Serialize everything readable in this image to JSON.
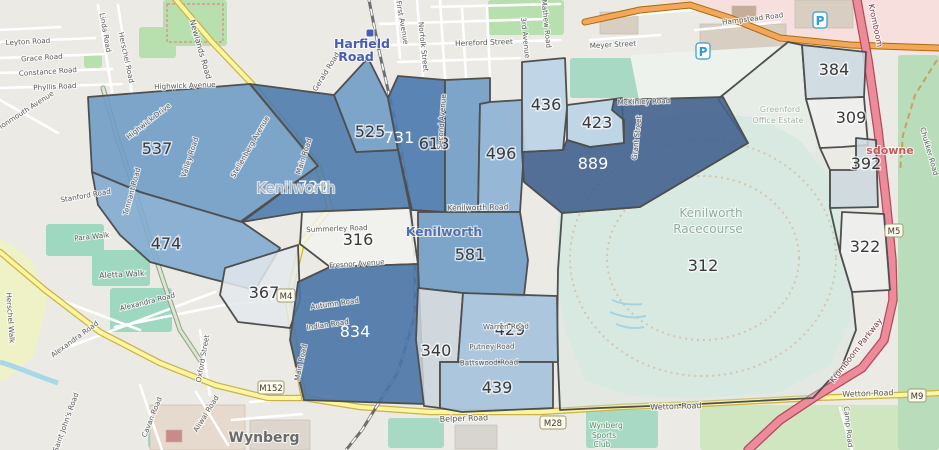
{
  "map": {
    "colors": {
      "region_border": "#4f4f4f",
      "road_yellow": "#fdf6a0",
      "road_orange": "#f2a75c",
      "road_trunk_pink": "#ec8b99",
      "racecourse_green": "#d9ece3",
      "park_green": "#b7e0ae",
      "pitch_teal": "#a8d9c4",
      "railway_gray": "#6e6e6e",
      "station_blue": "#4a5db5"
    },
    "regions": [
      {
        "value": "312",
        "fill": "#d5e6de",
        "text": "#3a3a3a",
        "lx": 703,
        "ly": 265,
        "opacity": 0.35,
        "points": "718,99 788,42 802,45 806,99 812,120 820,148 830,170 830,208 840,252 852,292 856,330 842,366 813,398 700,404 600,408 560,410 557,340 558,270 562,213 640,207 748,143"
      },
      {
        "value": "537",
        "fill": "#6d9bc6",
        "text": "#3a3a3a",
        "lx": 157,
        "ly": 148,
        "opacity": 0.88,
        "points": "88,97 250,84 318,166 240,222 140,192 92,172"
      },
      {
        "value": "720",
        "fill": "#4a79ad",
        "text": "#ffffff",
        "lx": 313,
        "ly": 186,
        "opacity": 0.88,
        "points": "250,84 334,95 356,152 398,150 410,208 302,212 242,222 318,166"
      },
      {
        "value": "525",
        "fill": "#6d9bc6",
        "text": "#3a3a3a",
        "lx": 370,
        "ly": 131,
        "opacity": 0.88,
        "points": "334,95 368,58 388,98 398,150 356,152"
      },
      {
        "value": "731",
        "fill": "#4a79ad",
        "text": "#ffffff",
        "lx": 399,
        "ly": 137,
        "opacity": 0.9,
        "points": "388,98 398,76 445,80 445,212 412,210 398,150"
      },
      {
        "value": "618",
        "fill": "#6d9bc6",
        "text": "#3a3a3a",
        "lx": 434,
        "ly": 143,
        "opacity": 0.88,
        "points": "445,80 490,78 490,102 480,104 478,212 445,212"
      },
      {
        "value": "496",
        "fill": "#8ab1d4",
        "text": "#3a3a3a",
        "lx": 501,
        "ly": 153,
        "opacity": 0.88,
        "points": "490,102 522,100 524,150 520,212 478,212 480,104"
      },
      {
        "value": "436",
        "fill": "#b9d2e6",
        "text": "#3a3a3a",
        "lx": 546,
        "ly": 104,
        "opacity": 0.88,
        "points": "522,62 565,58 567,108 563,150 522,152"
      },
      {
        "value": "423",
        "fill": "#b9d2e6",
        "text": "#3a3a3a",
        "lx": 597,
        "ly": 122,
        "opacity": 0.88,
        "points": "567,105 622,98 624,143 590,147 567,140"
      },
      {
        "value": "889",
        "fill": "#42628e",
        "text": "#ffffff",
        "lx": 593,
        "ly": 163,
        "opacity": 0.9,
        "points": "522,152 563,150 567,140 590,147 624,143 624,120 612,110 614,100 723,97 748,143 640,207 562,213 524,182"
      },
      {
        "value": "384",
        "fill": "#ccd9e2",
        "text": "#3a3a3a",
        "lx": 834,
        "ly": 69,
        "opacity": 0.85,
        "points": "802,45 866,52 864,97 806,99"
      },
      {
        "value": "309",
        "fill": "#eef0ef",
        "text": "#3a3a3a",
        "lx": 851,
        "ly": 117,
        "opacity": 0.85,
        "points": "806,99 864,97 868,145 842,147 820,148 812,120"
      },
      {
        "value": "392",
        "fill": "#cdd8de",
        "text": "#3a3a3a",
        "lx": 866,
        "ly": 163,
        "opacity": 0.85,
        "points": "856,138 876,140 878,207 830,208 830,170 856,170"
      },
      {
        "value": "322",
        "fill": "#eef0ef",
        "text": "#3a3a3a",
        "lx": 865,
        "ly": 246,
        "opacity": 0.85,
        "points": "842,212 884,214 890,290 852,292 840,252"
      },
      {
        "value": "474",
        "fill": "#7fa8cf",
        "text": "#3a3a3a",
        "lx": 166,
        "ly": 243,
        "opacity": 0.88,
        "points": "92,172 140,192 242,222 280,248 255,290 208,278 150,262 120,235 98,205"
      },
      {
        "value": "367",
        "fill": "#e4e9ec",
        "text": "#3a3a3a",
        "lx": 264,
        "ly": 292,
        "opacity": 0.85,
        "points": "225,268 298,245 300,300 290,328 238,322 220,295"
      },
      {
        "value": "316",
        "fill": "#f2f2f0",
        "text": "#3a3a3a",
        "lx": 358,
        "ly": 239,
        "opacity": 0.85,
        "points": "302,212 410,208 418,264 330,267 300,244"
      },
      {
        "value": "581",
        "fill": "#6d9bc6",
        "text": "#3a3a3a",
        "lx": 470,
        "ly": 254,
        "opacity": 0.88,
        "points": "418,212 520,212 528,260 524,296 463,293 418,288"
      },
      {
        "value": "834",
        "fill": "#4a74a6",
        "text": "#ffffff",
        "lx": 355,
        "ly": 331,
        "opacity": 0.9,
        "points": "330,267 418,264 424,404 304,400 290,340 298,282"
      },
      {
        "value": "340",
        "fill": "#ccd5dc",
        "text": "#3a3a3a",
        "lx": 436,
        "ly": 350,
        "opacity": 0.85,
        "points": "418,288 463,293 458,362 440,362 440,408 424,406 416,340"
      },
      {
        "value": "429",
        "fill": "#a3c2dc",
        "text": "#3a3a3a",
        "lx": 510,
        "ly": 329,
        "opacity": 0.88,
        "points": "463,293 557,296 558,362 458,362"
      },
      {
        "value": "439",
        "fill": "#a3c2dc",
        "text": "#3a3a3a",
        "lx": 497,
        "ly": 387,
        "opacity": 0.88,
        "points": "440,362 553,362 553,408 462,412 440,408"
      }
    ],
    "place_labels": [
      {
        "t": "Harfield",
        "x": 362,
        "y": 48,
        "s": 12.5,
        "c": "#4a5db5",
        "b": true
      },
      {
        "t": "Road",
        "x": 356,
        "y": 61,
        "s": 12.5,
        "c": "#4a5db5",
        "b": true
      },
      {
        "t": "Kenilworth",
        "x": 296,
        "y": 193,
        "s": 15,
        "c": "#a8b0b8",
        "b": false
      },
      {
        "t": "Kenilworth",
        "x": 444,
        "y": 236,
        "s": 12.5,
        "c": "#5570ae",
        "b": true
      },
      {
        "t": "Kenilworth",
        "x": 711,
        "y": 217,
        "s": 12,
        "c": "#93ac9e",
        "b": false
      },
      {
        "t": "Racecourse",
        "x": 708,
        "y": 233,
        "s": 12,
        "c": "#93ac9e",
        "b": false
      },
      {
        "t": "Greenford",
        "x": 780,
        "y": 112,
        "s": 8,
        "c": "#a3b2a3",
        "b": false
      },
      {
        "t": "Office Estate",
        "x": 778,
        "y": 123,
        "s": 8,
        "c": "#a3b2a3",
        "b": false
      },
      {
        "t": "Wynberg",
        "x": 264,
        "y": 442,
        "s": 14,
        "c": "#6b6b6b",
        "b": true
      },
      {
        "t": "Wynberg",
        "x": 606,
        "y": 428,
        "s": 7.5,
        "c": "#4f8f63",
        "b": false
      },
      {
        "t": "Sports",
        "x": 604,
        "y": 438,
        "s": 7.5,
        "c": "#4f8f63",
        "b": false
      },
      {
        "t": "Club",
        "x": 602,
        "y": 447,
        "s": 7.5,
        "c": "#4f8f63",
        "b": false
      },
      {
        "t": "sdowne",
        "x": 890,
        "y": 154,
        "s": 11,
        "c": "#cc5555",
        "b": true
      }
    ],
    "street_labels": [
      {
        "t": "Leyton Road",
        "x": 28,
        "y": 44,
        "r": -3
      },
      {
        "t": "Grace Road",
        "x": 42,
        "y": 60,
        "r": -4
      },
      {
        "t": "Constance Road",
        "x": 48,
        "y": 74,
        "r": -4
      },
      {
        "t": "Phyllis Road",
        "x": 55,
        "y": 89,
        "r": -3
      },
      {
        "t": "Monmouth Avenue",
        "x": 26,
        "y": 113,
        "r": -33
      },
      {
        "t": "Newlands Road",
        "x": 198,
        "y": 50,
        "r": 74,
        "s": 8
      },
      {
        "t": "Linda Road",
        "x": 103,
        "y": 33,
        "r": 80
      },
      {
        "t": "Herschel Road",
        "x": 124,
        "y": 58,
        "r": 78
      },
      {
        "t": "Herschel Walk",
        "x": 8,
        "y": 318,
        "r": 86
      },
      {
        "t": "Highwick Avenue",
        "x": 185,
        "y": 88,
        "r": -2
      },
      {
        "t": "Highwick Drive",
        "x": 150,
        "y": 123,
        "r": -38
      },
      {
        "t": "Valley Road",
        "x": 192,
        "y": 158,
        "r": -72
      },
      {
        "t": "Stellenberg Avenue",
        "x": 252,
        "y": 148,
        "r": -60
      },
      {
        "t": "Tennant Road",
        "x": 134,
        "y": 192,
        "r": -75
      },
      {
        "t": "Stanford Road",
        "x": 86,
        "y": 198,
        "r": -10
      },
      {
        "t": "Para Walk",
        "x": 92,
        "y": 239,
        "r": -6
      },
      {
        "t": "Aletta Walk",
        "x": 122,
        "y": 277,
        "r": -3,
        "s": 8
      },
      {
        "t": "Alexandra Road",
        "x": 148,
        "y": 304,
        "r": -14
      },
      {
        "t": "Alexandra Road",
        "x": 76,
        "y": 341,
        "r": -36
      },
      {
        "t": "Saint John's Road",
        "x": 68,
        "y": 423,
        "r": -70
      },
      {
        "t": "Cavan Road",
        "x": 154,
        "y": 418,
        "r": -68
      },
      {
        "t": "Aliwal Road",
        "x": 208,
        "y": 415,
        "r": -58
      },
      {
        "t": "Oxford Street",
        "x": 205,
        "y": 359,
        "r": -80
      },
      {
        "t": "Main Road",
        "x": 306,
        "y": 157,
        "r": -72
      },
      {
        "t": "Main Road",
        "x": 303,
        "y": 363,
        "r": -78
      },
      {
        "t": "Gerald Road",
        "x": 328,
        "y": 73,
        "r": -58
      },
      {
        "t": "First Avenue",
        "x": 400,
        "y": 23,
        "r": 80
      },
      {
        "t": "Norfolk Street",
        "x": 421,
        "y": 47,
        "r": 84
      },
      {
        "t": "Hereford Street",
        "x": 484,
        "y": 45,
        "r": -2,
        "s": 7.5
      },
      {
        "t": "3rd Avenue",
        "x": 523,
        "y": 38,
        "r": 84
      },
      {
        "t": "Mathew Road",
        "x": 544,
        "y": 24,
        "r": 84
      },
      {
        "t": "Meyer Street",
        "x": 613,
        "y": 47,
        "r": -3
      },
      {
        "t": "Hampstead Road",
        "x": 753,
        "y": 21,
        "r": -7
      },
      {
        "t": "McKinley Road",
        "x": 644,
        "y": 104,
        "r": -2
      },
      {
        "t": "Grant Street",
        "x": 639,
        "y": 138,
        "r": -84
      },
      {
        "t": "Second Avenue",
        "x": 444,
        "y": 122,
        "r": -86
      },
      {
        "t": "Kenilworth Road",
        "x": 478,
        "y": 210,
        "r": -1,
        "s": 7.5
      },
      {
        "t": "Summerley Road",
        "x": 337,
        "y": 231,
        "r": -2
      },
      {
        "t": "Fresnor Avenue",
        "x": 357,
        "y": 266,
        "r": -4
      },
      {
        "t": "Autumn Road",
        "x": 335,
        "y": 306,
        "r": -8
      },
      {
        "t": "Indian Road",
        "x": 328,
        "y": 327,
        "r": -8
      },
      {
        "t": "Warren Road",
        "x": 506,
        "y": 329,
        "r": -1
      },
      {
        "t": "Putney Road",
        "x": 492,
        "y": 349,
        "r": -1
      },
      {
        "t": "Battswood Road",
        "x": 489,
        "y": 365,
        "r": -1
      },
      {
        "t": "Belper Road",
        "x": 464,
        "y": 421,
        "r": -2,
        "s": 8
      },
      {
        "t": "Wetton Road",
        "x": 676,
        "y": 409,
        "r": -2,
        "s": 8
      },
      {
        "t": "Wetton Road",
        "x": 868,
        "y": 396,
        "r": -2,
        "s": 8
      },
      {
        "t": "Kromboom Parkway",
        "x": 858,
        "y": 352,
        "r": -52,
        "s": 8,
        "c": "#7a3540"
      },
      {
        "t": "Kromboom",
        "x": 873,
        "y": 26,
        "r": 78,
        "s": 8,
        "c": "#7a3540"
      },
      {
        "t": "Chukker Road",
        "x": 927,
        "y": 152,
        "r": 74
      },
      {
        "t": "Camp Road",
        "x": 846,
        "y": 427,
        "r": 84
      }
    ],
    "road_shields": [
      {
        "t": "M152",
        "x": 271,
        "y": 388
      },
      {
        "t": "M28",
        "x": 553,
        "y": 423
      },
      {
        "t": "M9",
        "x": 917,
        "y": 396
      },
      {
        "t": "M5",
        "x": 894,
        "y": 231
      },
      {
        "t": "M4",
        "x": 286,
        "y": 296
      }
    ],
    "parking_icons": [
      {
        "x": 703,
        "y": 51
      },
      {
        "x": 820,
        "y": 20
      }
    ],
    "station_icon": {
      "x": 366,
      "y": 29
    }
  }
}
